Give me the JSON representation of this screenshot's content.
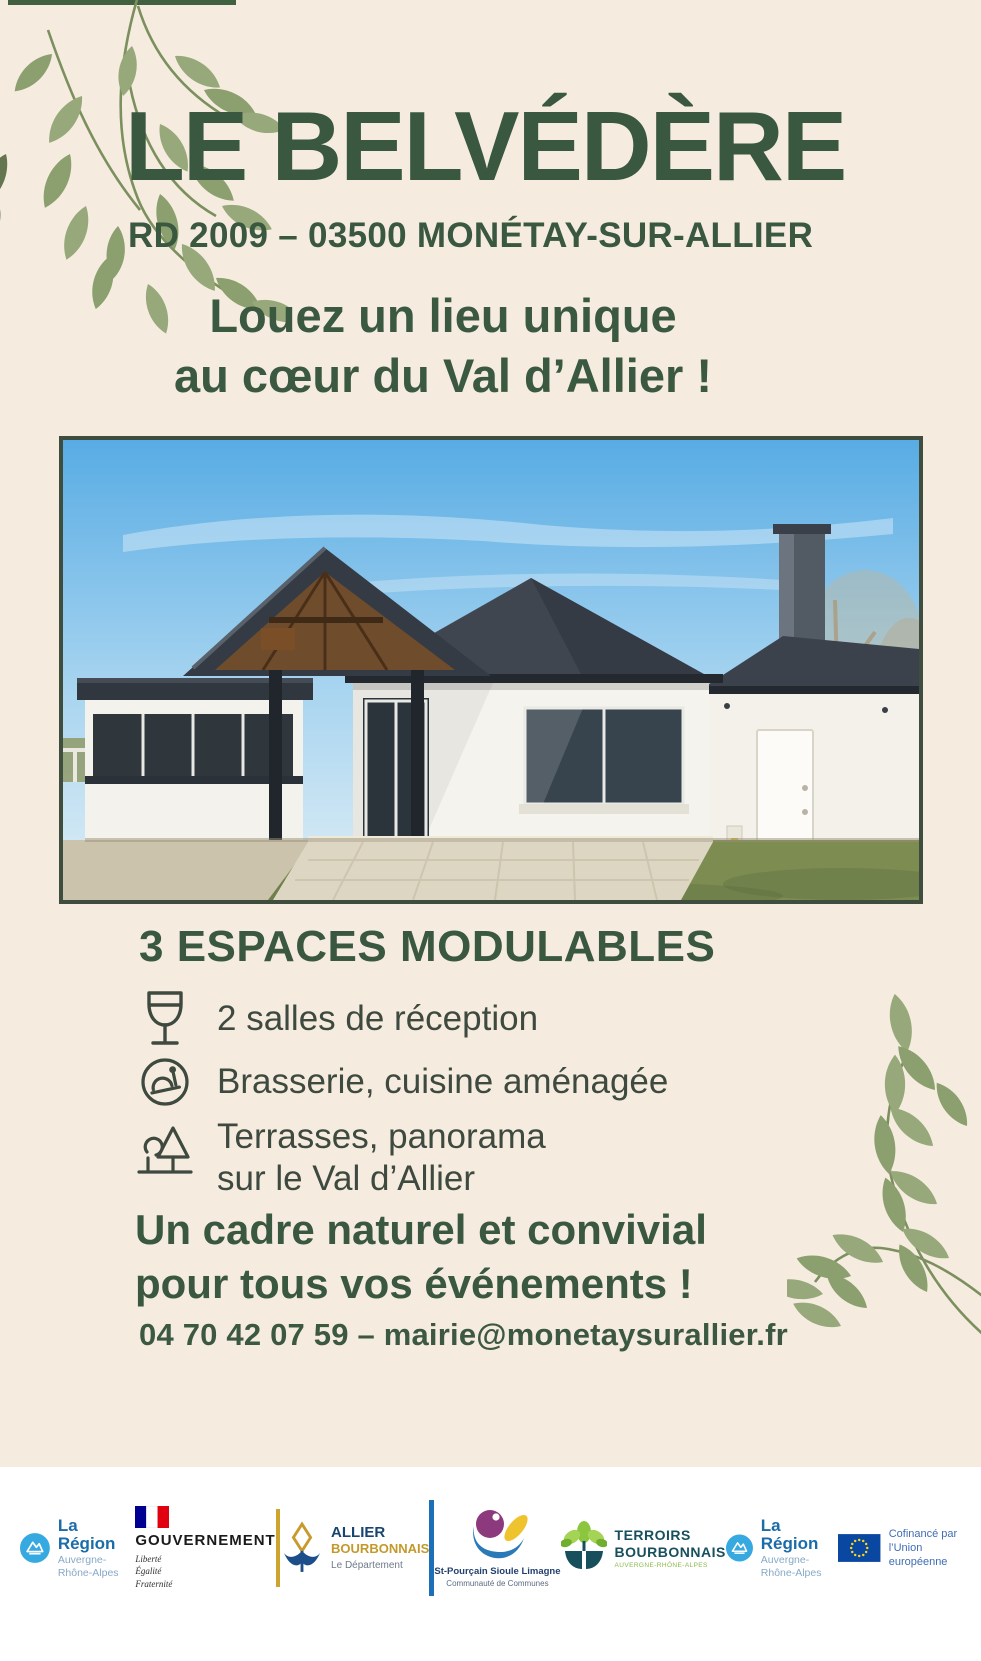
{
  "poster": {
    "title": "LE BELVÉDÈRE",
    "address": "RD 2009 – 03500 MONÉTAY-SUR-ALLIER",
    "tagline": [
      "Louez un lieu unique",
      "au cœur du Val d’Allier !"
    ],
    "section_heading": "3 ESPACES MODULABLES",
    "features": [
      {
        "icon": "wine-glass-icon",
        "text": "2 salles de réception"
      },
      {
        "icon": "food-cloche-icon",
        "text": "Brasserie, cuisine aménagée"
      },
      {
        "icon": "park-tree-icon",
        "lines": [
          "Terrasses, panorama",
          "sur le Val d’Allier"
        ]
      }
    ],
    "closing": [
      "Un cadre naturel et convivial",
      "pour tous vos événements !"
    ],
    "contact": "04 70 42 07 59 – mairie@monetaysurallier.fr",
    "colors": {
      "heading_green": "#3a5740",
      "leaf_sage": "#97a87b",
      "background_beige": "#f5ecdf"
    }
  },
  "footer": {
    "logos": {
      "region": {
        "title": "La Région",
        "subtitle": "Auvergne-Rhône-Alpes"
      },
      "gouvernement": {
        "title": "GOUVERNEMENT",
        "motto": [
          "Liberté",
          "Égalité",
          "Fraternité"
        ]
      },
      "allier": {
        "line1": "ALLIER",
        "line2": "BOURBONNAIS",
        "line3": "Le Département"
      },
      "st_pourcain": {
        "line1": "St-Pourçain Sioule Limagne",
        "line2": "Communauté de Communes"
      },
      "terroirs": {
        "line1": "TERROIRS",
        "line2": "BOURBONNAIS",
        "tagline": "AUVERGNE-RHÔNE-ALPES"
      },
      "region2": {
        "title": "La Région",
        "subtitle": "Auvergne-Rhône-Alpes"
      },
      "eu": {
        "line1": "Cofinancé par",
        "line2": "l’Union européenne"
      }
    }
  }
}
